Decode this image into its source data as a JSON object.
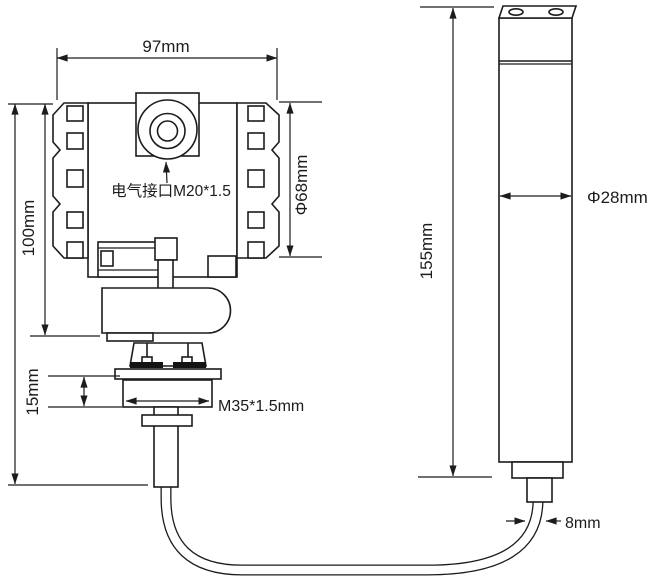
{
  "drawing": {
    "type": "technical-dimension-drawing",
    "subject": "pressure transmitter with remote cylindrical probe and connection cable",
    "colors": {
      "line": "#1c1c1c",
      "background": "#ffffff"
    },
    "transmitter": {
      "width_label": "97mm",
      "height_label": "100mm",
      "cover_diameter_label": "Φ68mm",
      "electrical_port_label": "电气接口M20*1.5",
      "thread_height_label": "15mm",
      "process_thread_label": "M35*1.5mm"
    },
    "probe": {
      "height_label": "155mm",
      "diameter_label": "Φ28mm",
      "cable_diameter_label": "8mm"
    }
  }
}
